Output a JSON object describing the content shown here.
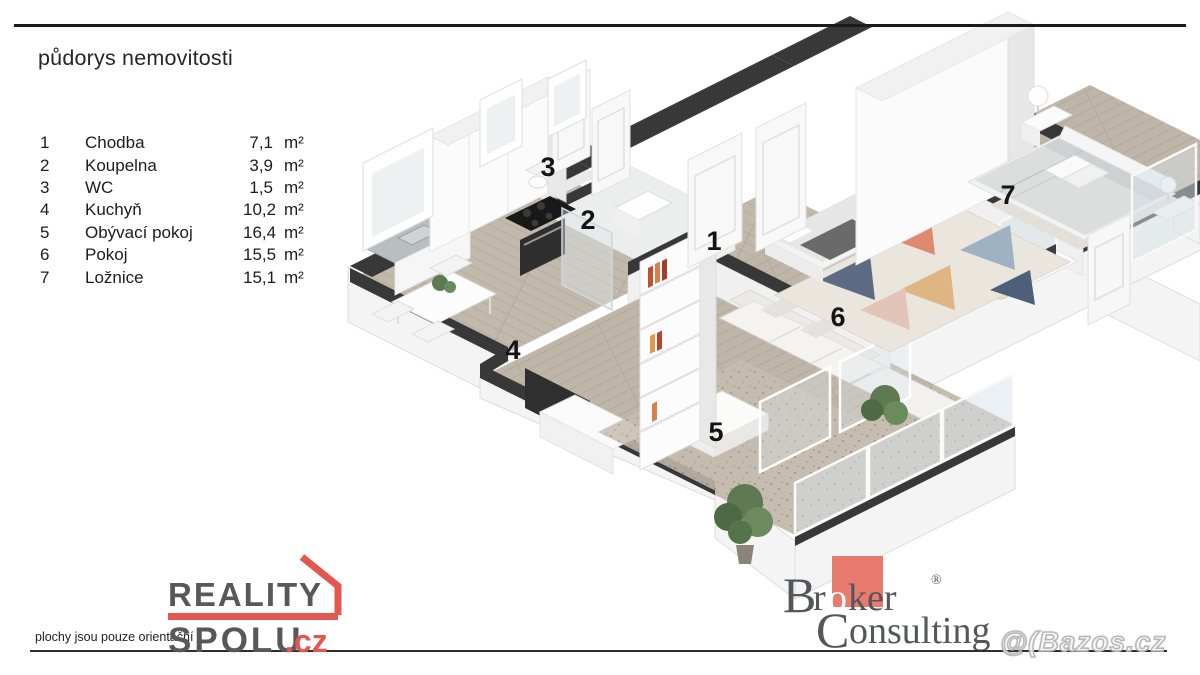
{
  "header": {
    "title": "půdorys nemovitosti"
  },
  "legend": {
    "rows": [
      {
        "num": "1",
        "name": "Chodba",
        "value": "7,1",
        "unit": "m²"
      },
      {
        "num": "2",
        "name": "Koupelna",
        "value": "3,9",
        "unit": "m²"
      },
      {
        "num": "3",
        "name": "WC",
        "value": "1,5",
        "unit": "m²"
      },
      {
        "num": "4",
        "name": "Kuchyň",
        "value": "10,2",
        "unit": "m²"
      },
      {
        "num": "5",
        "name": "Obývací pokoj",
        "value": "16,4",
        "unit": "m²"
      },
      {
        "num": "6",
        "name": "Pokoj",
        "value": "15,5",
        "unit": "m²"
      },
      {
        "num": "7",
        "name": "Ložnice",
        "value": "15,1",
        "unit": "m²"
      }
    ]
  },
  "plan": {
    "labels": {
      "hallway": "1",
      "bathroom": "2",
      "wc": "3",
      "kitchen": "4",
      "living": "5",
      "room": "6",
      "bedroom": "7"
    },
    "colors": {
      "wall_dark": "#383838",
      "wall_white": "#f6f6f6",
      "floor_wood": "#bfb5a8",
      "rug_accent": "#dd8a70"
    }
  },
  "footer": {
    "disclaimer": "plochy jsou pouze orientační",
    "reality": {
      "line1": "REALITY",
      "line2": "SPOLU",
      "tld": ".cz",
      "accent": "#e4574f"
    },
    "broker": {
      "b": "B",
      "r": "r",
      "o": "o",
      "ker": "ker",
      "reg": "®",
      "c": "C",
      "onsulting": "onsulting",
      "accent": "#e87b6d"
    },
    "watermark": "@(Bazos.cz"
  }
}
